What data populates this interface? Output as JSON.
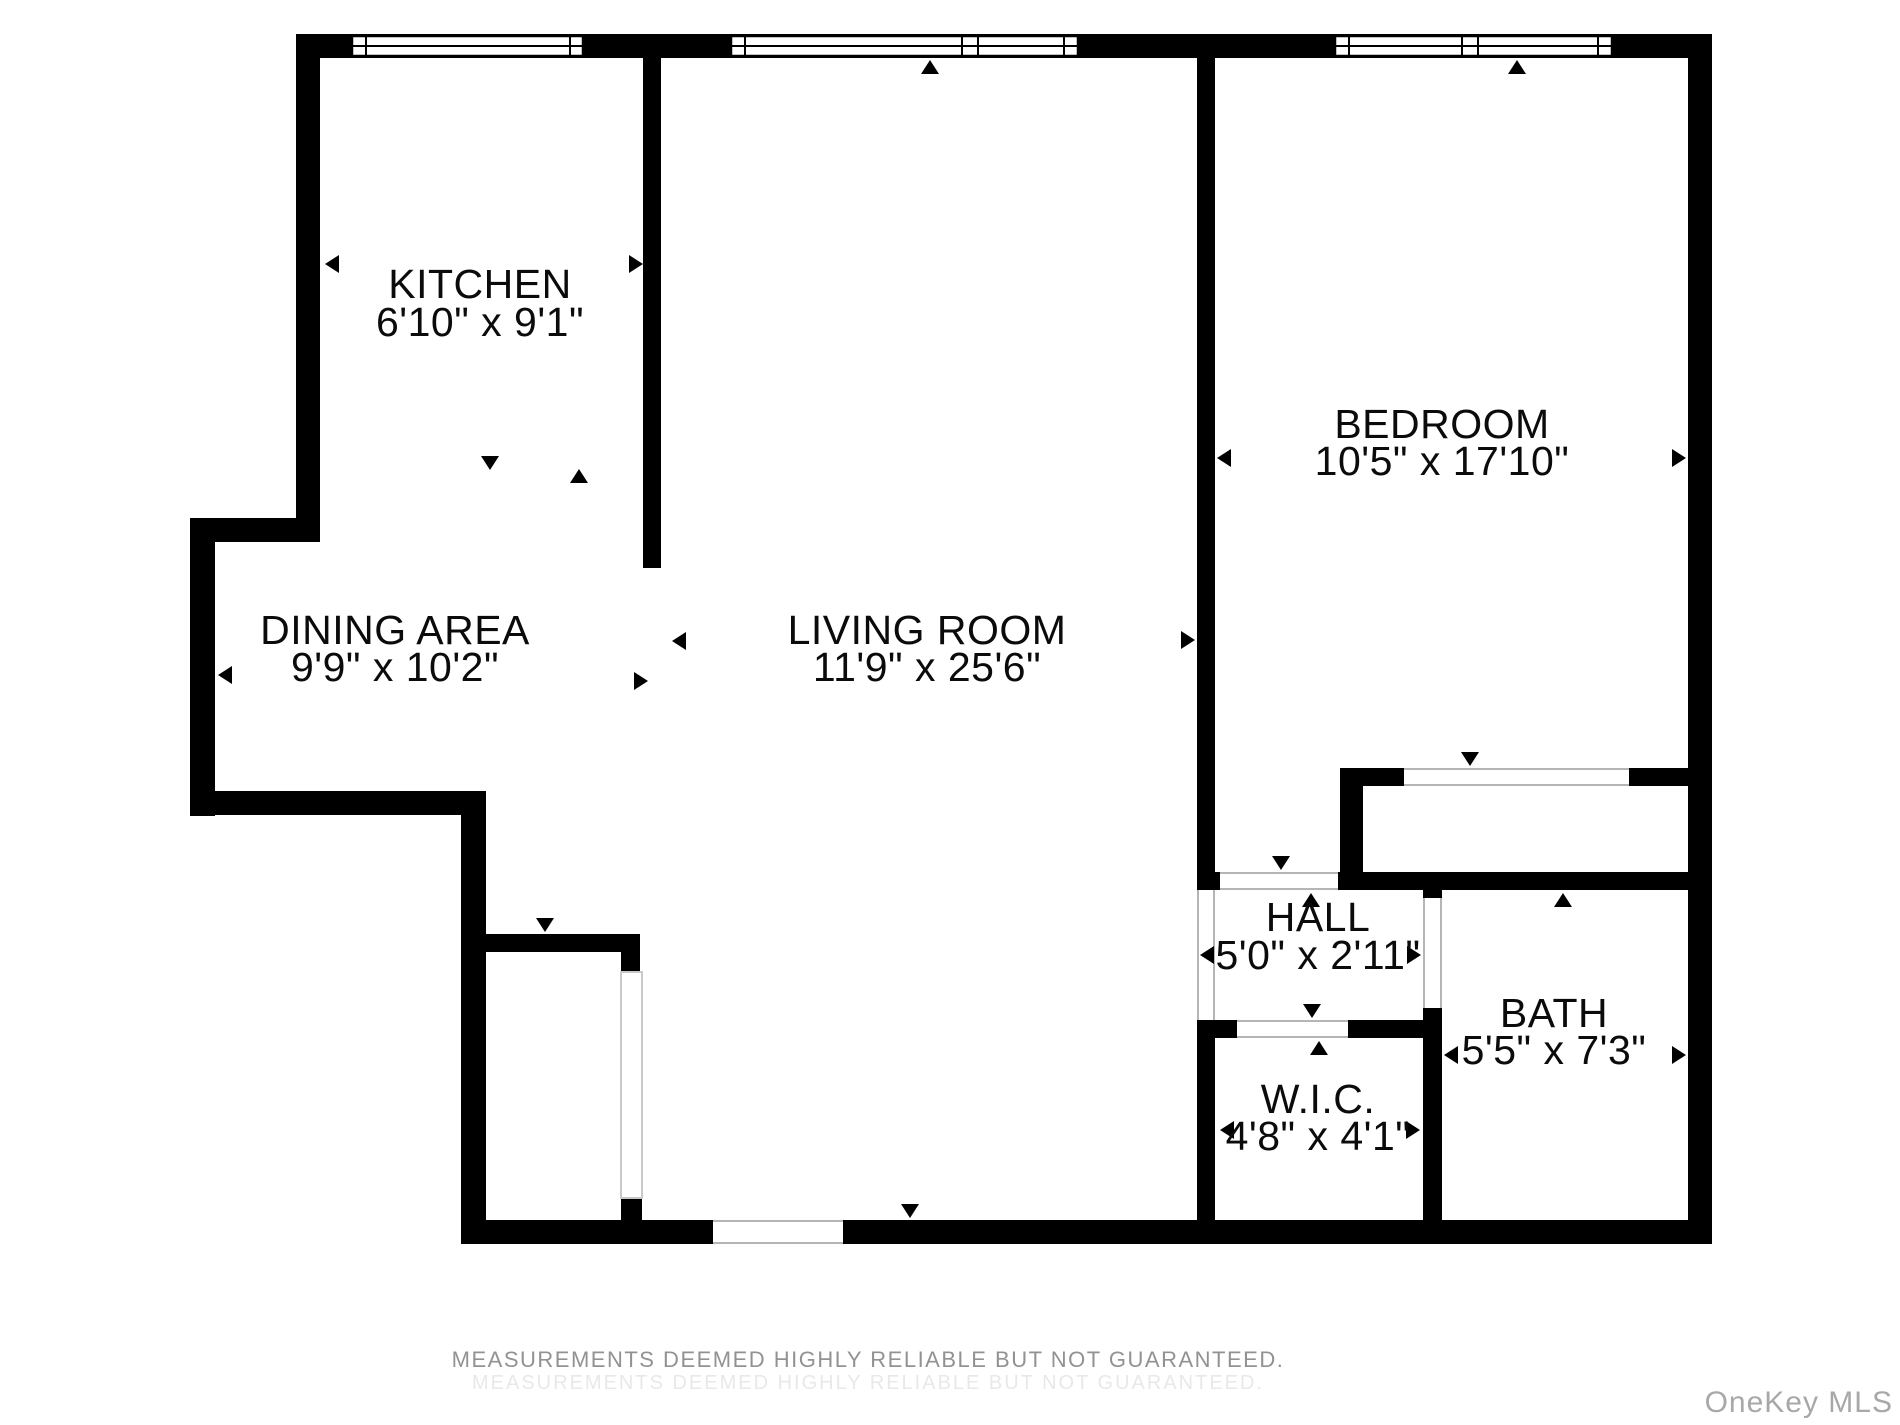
{
  "plan": {
    "rooms": [
      {
        "name": "KITCHEN",
        "dims": "6'10\" x 9'1\""
      },
      {
        "name": "DINING AREA",
        "dims": "9'9\" x 10'2\""
      },
      {
        "name": "LIVING ROOM",
        "dims": "11'9\" x 25'6\""
      },
      {
        "name": "BEDROOM",
        "dims": "10'5\" x 17'10\""
      },
      {
        "name": "HALL",
        "dims": "5'0\" x 2'11\""
      },
      {
        "name": "BATH",
        "dims": "5'5\" x 7'3\""
      },
      {
        "name": "W.I.C.",
        "dims": "4'8\" x 4'1\""
      }
    ]
  },
  "footer": {
    "disclaimer": "MEASUREMENTS DEEMED HIGHLY RELIABLE BUT NOT GUARANTEED.",
    "faint_line": "MEASUREMENTS DEEMED HIGHLY RELIABLE BUT NOT GUARANTEED.",
    "watermark": "OneKey MLS"
  }
}
